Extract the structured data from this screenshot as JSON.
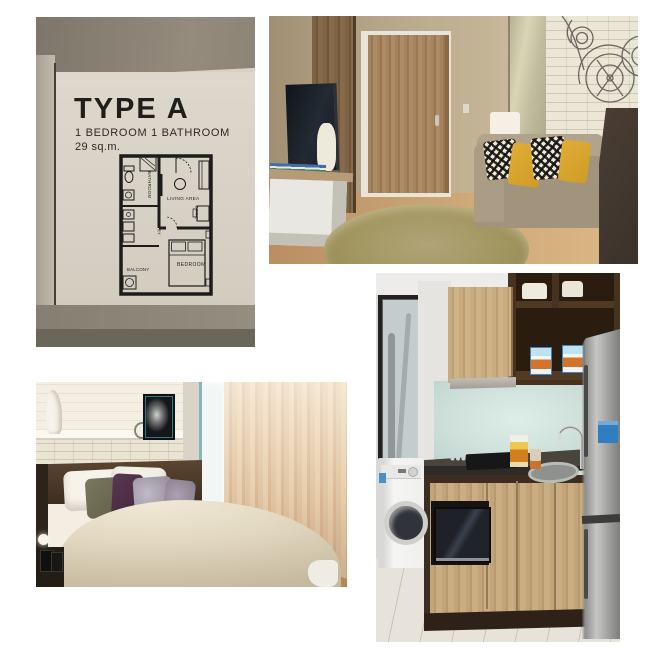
{
  "sign": {
    "title": "TYPE A",
    "subtitle": "1 BEDROOM 1 BATHROOM",
    "area": "29 sq.m.",
    "plan_rooms": {
      "bathroom": "BATHROOM",
      "pantry": "PANTRY",
      "balcony": "BALCONY",
      "living": "LIVING AREA",
      "dining": "DINING",
      "bedroom": "BEDROOM"
    }
  },
  "colors": {
    "background": "#ffffff",
    "sign_board": "#d8d2c6",
    "sign_text": "#201e1a",
    "brick_wall": "#ece6d6",
    "sofa": "#a2937c",
    "pillow_yellow": "#d7a32e",
    "door_wood": "#a5835e",
    "curtain": "#e6cbaa",
    "duvet": "#e3d9c2",
    "backsplash": "#cfe0da",
    "cabinet_wood": "#c9ab80",
    "cabinet_dark": "#46321f",
    "fridge_steel": "#a2a2a0",
    "fridge_label": "#2e7ec0",
    "floor_wood": "#cfa977"
  }
}
